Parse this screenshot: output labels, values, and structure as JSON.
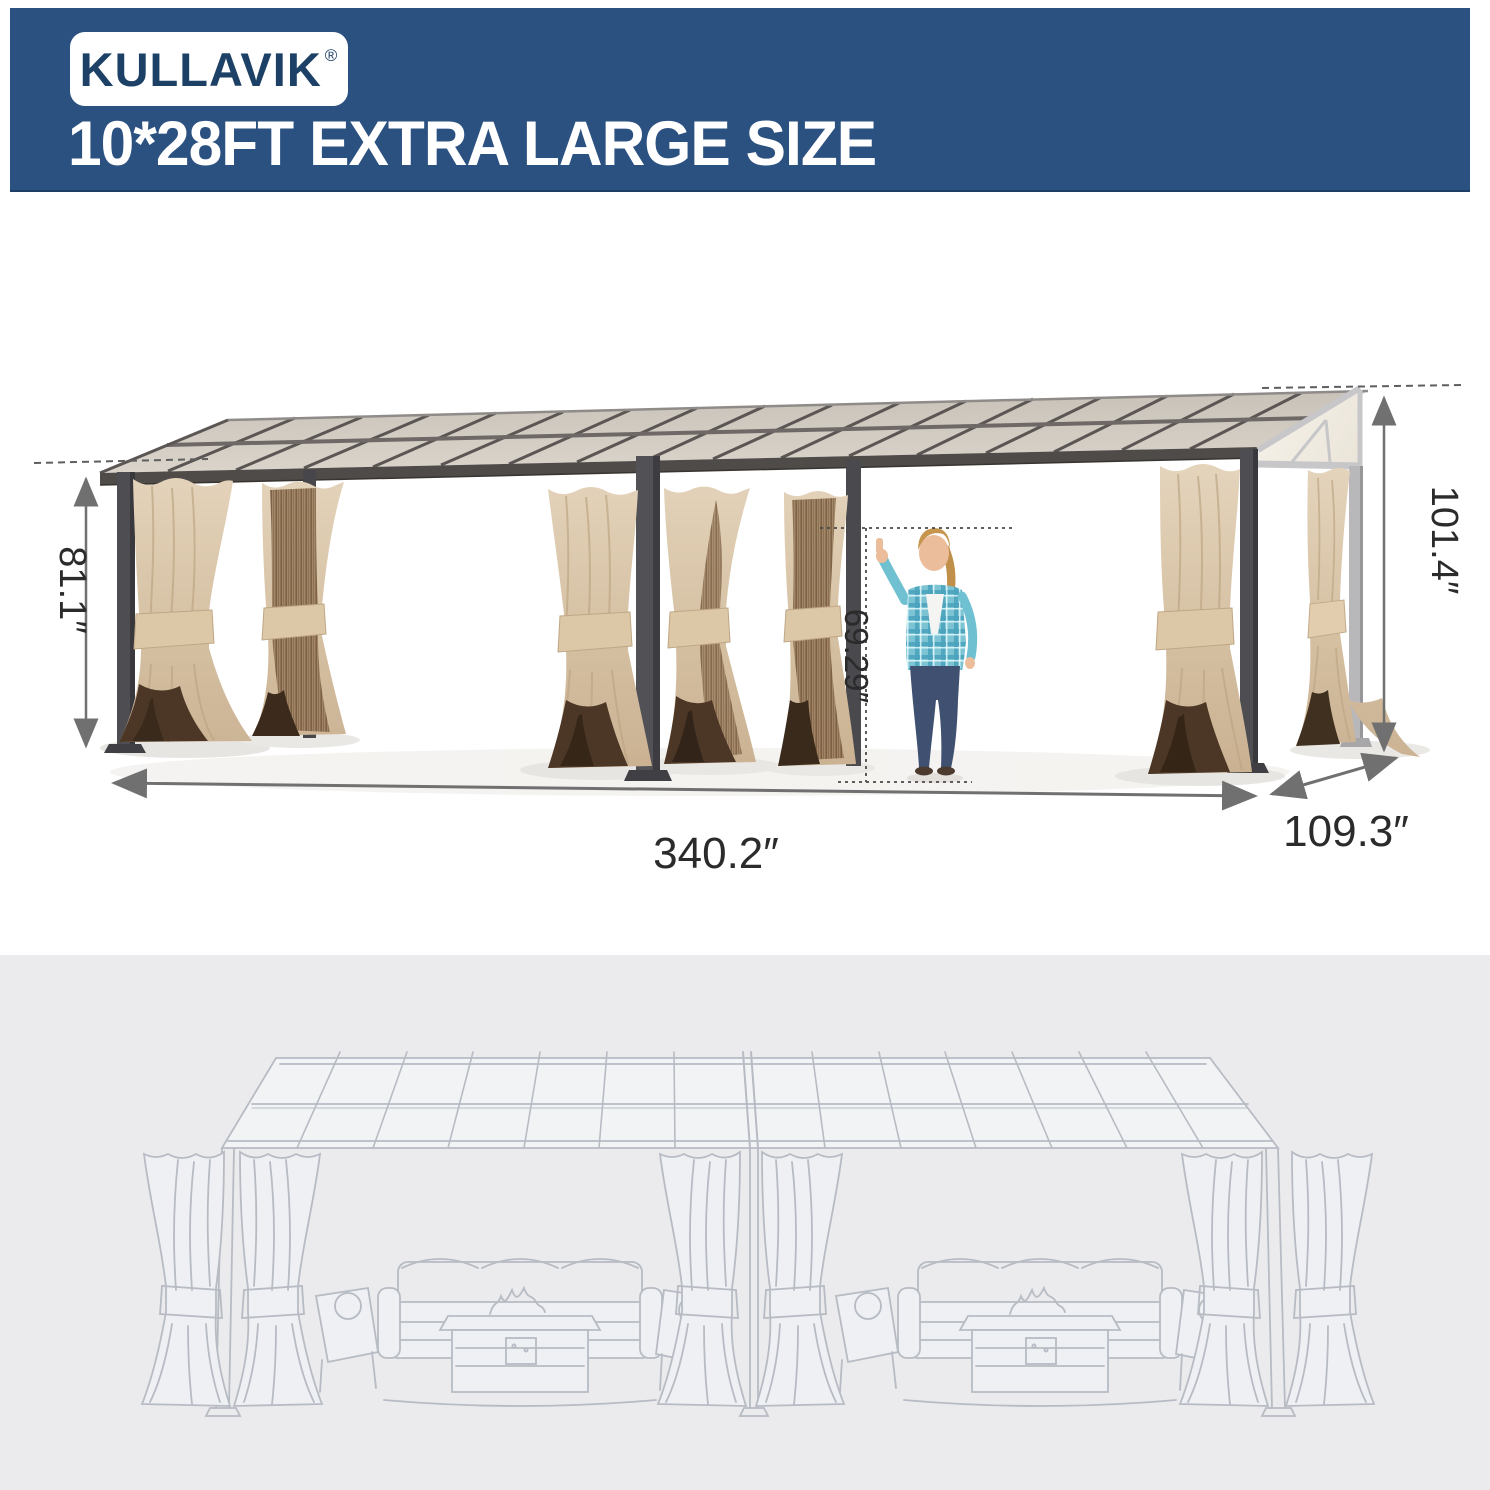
{
  "banner": {
    "brand": "KULLAVIK",
    "registered_mark": "®",
    "headline": "10*28FT EXTRA LARGE SIZE"
  },
  "dimensions": {
    "front_height": "81.1″",
    "back_height": "101.4″",
    "person_height": "69.29″",
    "length": "340.2″",
    "depth": "109.3″"
  },
  "icons": {
    "length_arrow": "double-headed-arrow",
    "depth_arrow": "double-headed-arrow",
    "front_height_arrow": "double-headed-arrow",
    "back_height_arrow": "double-headed-arrow",
    "reference_line": "dashed-line"
  },
  "colors": {
    "banner_blue": "#2b5181",
    "brand_navy": "#1d4066",
    "headline_white": "#ffffff",
    "annotation_text": "#2b2b2b",
    "arrow_gray": "#707070",
    "frame_dark": "#4d4d52",
    "frame_light": "#b9b9bc",
    "roof_beige": "#d6cfc6",
    "curtain_beige": "#d7c4aa",
    "curtain_brown": "#4c3726",
    "mesh_brown": "#9c7f61",
    "sketch_bg": "#ebebed",
    "sketch_line": "#b7bbc3"
  }
}
